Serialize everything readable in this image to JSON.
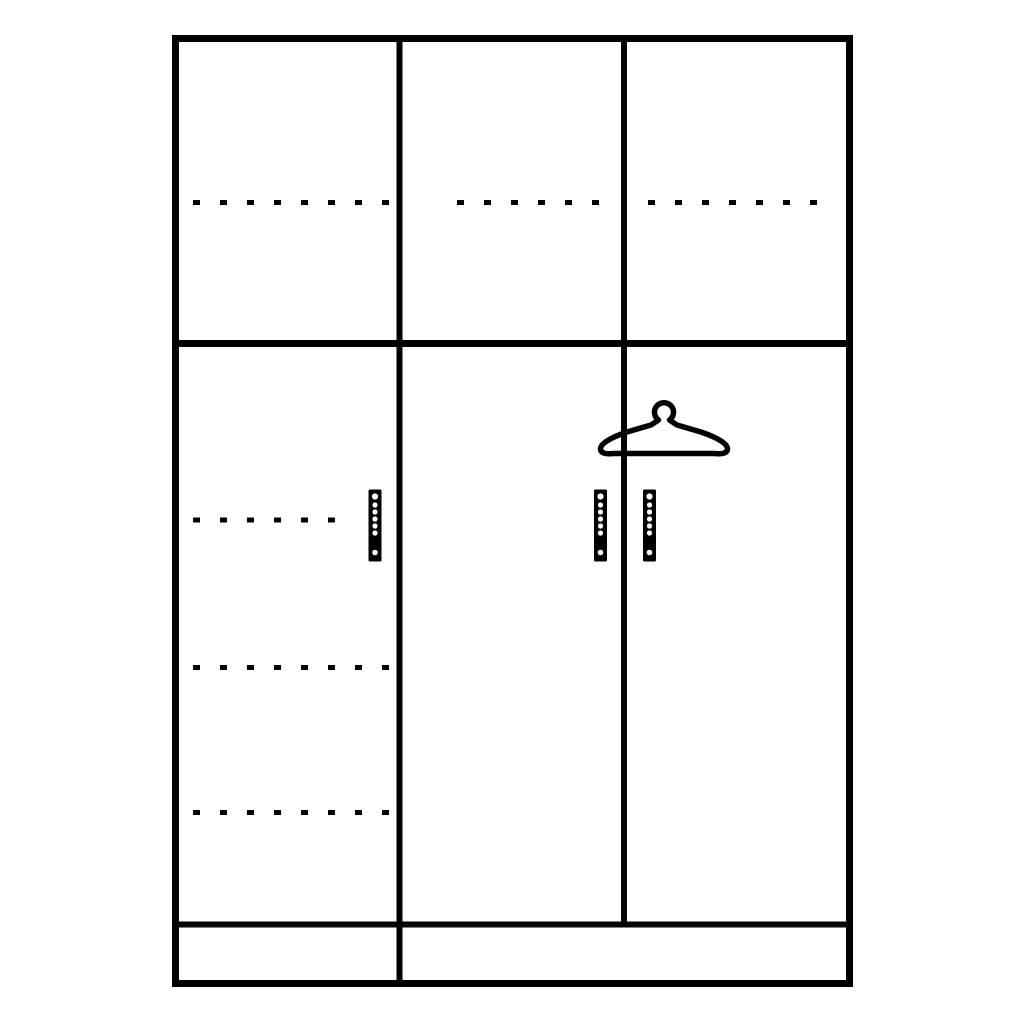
{
  "colors": {
    "background": "#ffffff",
    "line": "#000000"
  },
  "diagram": {
    "type": "wardrobe-line-drawing",
    "top_compartments": 3,
    "doors": 3,
    "door_handles": 3,
    "handle_dot_count": 7,
    "dashed_shelf_lines_top_row": 3,
    "dashed_shelf_lines_left_door": 3,
    "symbols": [
      "clothes-hanger-icon"
    ],
    "plinth_dividers": 1
  }
}
